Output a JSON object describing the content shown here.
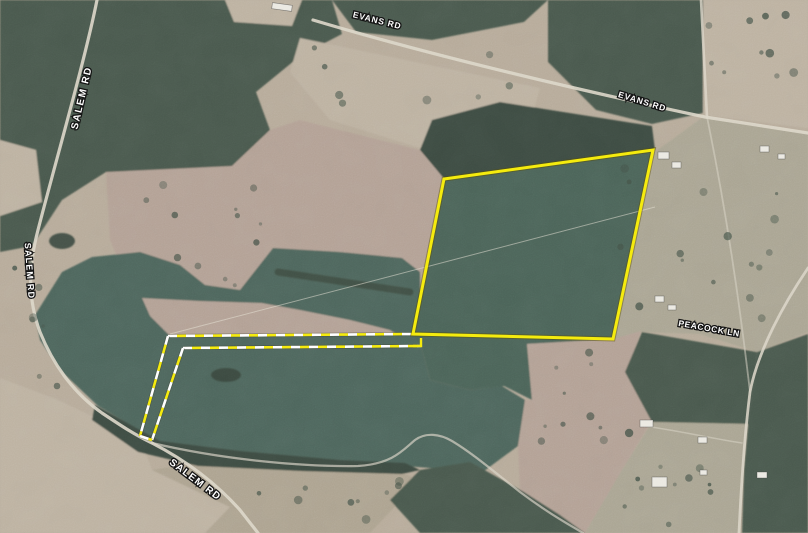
{
  "map": {
    "description": "aerial-parcel-map",
    "palette": {
      "base": "#b6aa99",
      "forest": "#4a594d",
      "forest_dark": "#3e4c42",
      "field": "#4e655b",
      "field2": "#4c6358",
      "cutover": "#b2a094",
      "pasture": "#a9a492",
      "clearing": "#bcb1a0",
      "brush": "#aca28f",
      "road": "#dcd6c8",
      "tree": "#445248",
      "pond": "#39473d",
      "structure": "#ebe9e2",
      "boundary": "#f5eb0e",
      "boundary_halo": "rgba(90,80,0,0.45)",
      "dash_white": "#ffffff",
      "dash_halo": "rgba(60,60,40,0.35)",
      "powerline": "#e9e5d8",
      "label_fill": "#ffffff",
      "label_stroke": "#141414"
    },
    "labels": [
      {
        "id": "evans-rd-1",
        "text": "EVANS RD",
        "x": 377,
        "y": 21,
        "rotate": 14,
        "size": 8.5,
        "spacing": 0.8
      },
      {
        "id": "evans-rd-2",
        "text": "EVANS RD",
        "x": 642,
        "y": 102,
        "rotate": 17,
        "size": 8.5,
        "spacing": 0.8
      },
      {
        "id": "salem-rd-1",
        "text": "SALEM RD",
        "x": 82,
        "y": 98,
        "rotate": -77,
        "size": 10,
        "spacing": 1.5
      },
      {
        "id": "salem-rd-2",
        "text": "SALEM RD",
        "x": 29,
        "y": 271,
        "rotate": 86,
        "size": 9,
        "spacing": 1.2
      },
      {
        "id": "salem-rd-3",
        "text": "SALEM RD",
        "x": 195,
        "y": 480,
        "rotate": 37,
        "size": 10,
        "spacing": 1.2
      },
      {
        "id": "peacock-ln",
        "text": "PEACOCK LN",
        "x": 709,
        "y": 329,
        "rotate": 10,
        "size": 8.5,
        "spacing": 0.6
      }
    ],
    "parcel": {
      "points": "444,179 653,150 613,339 413,334",
      "notch": "421,338 421,346 413,346"
    },
    "easement": {
      "dash": [
        9,
        9
      ],
      "width": 2.6,
      "lines": [
        {
          "id": "north",
          "d": "M168,336 L413,334"
        },
        {
          "id": "south",
          "d": "M183,348 L421,346"
        },
        {
          "id": "west",
          "d": "M168,336 L140,436"
        },
        {
          "id": "east",
          "d": "M183,348 L152,440"
        },
        {
          "id": "cap",
          "d": "M140,436 L152,440"
        }
      ]
    },
    "powerline": {
      "d": "M170,334 L655,207"
    },
    "roads": [
      {
        "id": "evans-rd",
        "d": "M313,20 C420,52 560,86 705,117 L808,133",
        "w": 3.2,
        "o": 0.9
      },
      {
        "id": "north-spur",
        "d": "M701,0 L707,117",
        "w": 2.6,
        "o": 0.8
      },
      {
        "id": "peacock-ln",
        "d": "M808,268 C785,302 758,350 750,392 C744,440 741,490 739,533",
        "w": 2.8,
        "o": 0.85
      },
      {
        "id": "peacock-connector",
        "d": "M707,117 C722,190 737,280 750,392",
        "w": 1.8,
        "o": 0.5
      },
      {
        "id": "salem-rd",
        "d": "M97,0 C85,60 56,160 38,230 C28,268 28,300 40,332 C52,362 72,392 102,413 C120,425 135,435 152,443 C185,460 215,482 240,510 L258,533",
        "w": 3.2,
        "o": 0.9
      },
      {
        "id": "field-track",
        "d": "M152,443 C220,459 300,467 358,466 C393,464 404,449 415,440 C426,432 440,434 452,441 C472,453 492,470 520,492 C548,513 568,524 583,533",
        "w": 2.2,
        "o": 0.65
      },
      {
        "id": "driveway",
        "d": "M645,426 C685,432 710,438 742,443",
        "w": 1.6,
        "o": 0.5
      }
    ],
    "terrain": [
      {
        "id": "forest-nw",
        "kind": "forest",
        "d": "M0,0 L332,0 L342,34 L300,56 L256,92 L270,130 L232,166 L166,182 L106,172 L62,200 L32,246 L0,252 Z"
      },
      {
        "id": "forest-top-mid",
        "kind": "forest",
        "d": "M332,0 L548,0 L524,22 L432,40 L356,32 Z"
      },
      {
        "id": "forest-top-right",
        "kind": "forest",
        "d": "M548,0 L703,0 L703,113 L652,124 L596,110 L548,62 Z"
      },
      {
        "id": "clearing-evans",
        "kind": "clearing",
        "d": "M300,38 L540,88 L528,130 L420,148 L330,120 L290,72 Z"
      },
      {
        "id": "forest-pines",
        "kind": "forest_dark",
        "d": "M500,102 L652,126 L655,150 L445,180 L420,150 L432,120 Z"
      },
      {
        "id": "clearing-top-right",
        "kind": "clearing",
        "d": "M703,0 L808,0 L808,128 L703,115 Z"
      },
      {
        "id": "pasture-right",
        "kind": "pasture",
        "d": "M655,152 L703,117 L808,133 L808,332 L757,352 L700,334 L642,332 L614,339 Z"
      },
      {
        "id": "cutover-mid",
        "kind": "cutover",
        "d": "M106,172 L232,166 L270,130 L300,120 L420,150 L445,180 L413,334 L168,336 L135,300 L110,240 Z"
      },
      {
        "id": "field-central",
        "kind": "field",
        "d": "M35,315 L62,272 L92,257 L140,252 L180,265 L205,285 L240,290 L273,248 L340,252 L402,258 L420,272 L421,346 L430,380 L470,390 L502,386 L525,400 L518,446 L480,474 L430,468 L340,461 L240,452 L160,442 L98,406 L60,370 L40,340 Z"
      },
      {
        "id": "cutover-peninsula",
        "kind": "cutover",
        "d": "M142,298 L200,301 L262,303 L300,310 L350,320 L390,330 L396,334 L170,336 L150,316 Z"
      },
      {
        "id": "treerow-lobe",
        "kind": "treerow",
        "d": "M278,272 L410,292",
        "w": 7
      },
      {
        "id": "field-parcel",
        "kind": "field2",
        "d": "M444,179 L653,150 L613,339 L527,344 L532,400 L504,386 L470,390 L430,380 L421,346 L413,334 Z"
      },
      {
        "id": "cutover-se",
        "kind": "cutover",
        "d": "M527,344 L613,339 L641,331 L627,372 L652,420 L622,470 L585,533 L545,505 L520,492 L518,446 L525,400 L532,400 Z"
      },
      {
        "id": "clearing-bottom-left",
        "kind": "clearing",
        "d": "M0,378 L58,400 L96,418 L140,438 L152,470 L230,507 L205,533 L0,533 Z"
      },
      {
        "id": "brush-bottom",
        "kind": "brush",
        "d": "M152,470 L230,507 L205,533 L370,533 L420,480 L400,472 L300,470 L200,462 Z"
      },
      {
        "id": "forest-bottom-strip",
        "kind": "forest_dark",
        "d": "M95,405 L160,441 L240,451 L340,460 L405,463 L420,470 L402,474 L300,471 L198,466 L138,452 L92,420 Z"
      },
      {
        "id": "forest-bottom-center",
        "kind": "forest",
        "d": "M420,470 L470,462 L524,492 L560,515 L585,533 L420,533 L390,500 Z"
      },
      {
        "id": "forest-peacock-band",
        "kind": "forest",
        "d": "M642,332 L757,352 L748,424 L652,422 L625,372 Z"
      },
      {
        "id": "forest-right-edge",
        "kind": "forest",
        "d": "M757,352 L808,334 L808,533 L742,533 L744,468 L748,424 Z"
      },
      {
        "id": "pasture-bottom-right",
        "kind": "pasture",
        "d": "M652,422 L748,424 L744,468 L740,533 L585,533 L622,470 Z"
      },
      {
        "id": "clearing-top-notch",
        "kind": "clearing",
        "d": "M225,0 L302,0 L292,26 L234,22 Z"
      },
      {
        "id": "clearing-left-edge",
        "kind": "clearing",
        "d": "M0,140 L36,150 L42,202 L0,216 Z"
      }
    ],
    "ponds": [
      {
        "cx": 62,
        "cy": 241,
        "rx": 13,
        "ry": 8
      },
      {
        "cx": 226,
        "cy": 375,
        "rx": 15,
        "ry": 7
      }
    ],
    "structures": [
      {
        "x": 272,
        "y": 4,
        "w": 20,
        "h": 6,
        "r": 8
      },
      {
        "x": 658,
        "y": 152,
        "w": 11,
        "h": 7,
        "r": 0
      },
      {
        "x": 672,
        "y": 162,
        "w": 9,
        "h": 6,
        "r": 0
      },
      {
        "x": 760,
        "y": 146,
        "w": 9,
        "h": 6,
        "r": 0
      },
      {
        "x": 778,
        "y": 154,
        "w": 7,
        "h": 5,
        "r": 0
      },
      {
        "x": 655,
        "y": 296,
        "w": 9,
        "h": 6,
        "r": 0
      },
      {
        "x": 668,
        "y": 305,
        "w": 8,
        "h": 5,
        "r": 0
      },
      {
        "x": 640,
        "y": 420,
        "w": 13,
        "h": 7,
        "r": 0
      },
      {
        "x": 698,
        "y": 437,
        "w": 9,
        "h": 6,
        "r": 0
      },
      {
        "x": 652,
        "y": 477,
        "w": 15,
        "h": 10,
        "r": 0
      },
      {
        "x": 757,
        "y": 472,
        "w": 10,
        "h": 6,
        "r": 0
      },
      {
        "x": 700,
        "y": 470,
        "w": 7,
        "h": 5,
        "r": 0
      }
    ],
    "tree_scatter_boxes": [
      [
        620,
        140,
        185,
        185,
        16
      ],
      [
        590,
        425,
        145,
        100,
        12
      ],
      [
        2,
        255,
        58,
        140,
        8
      ],
      [
        105,
        180,
        170,
        112,
        12
      ],
      [
        528,
        350,
        92,
        108,
        9
      ],
      [
        305,
        45,
        210,
        78,
        8
      ],
      [
        705,
        10,
        98,
        100,
        10
      ],
      [
        250,
        472,
        160,
        52,
        9
      ]
    ]
  }
}
